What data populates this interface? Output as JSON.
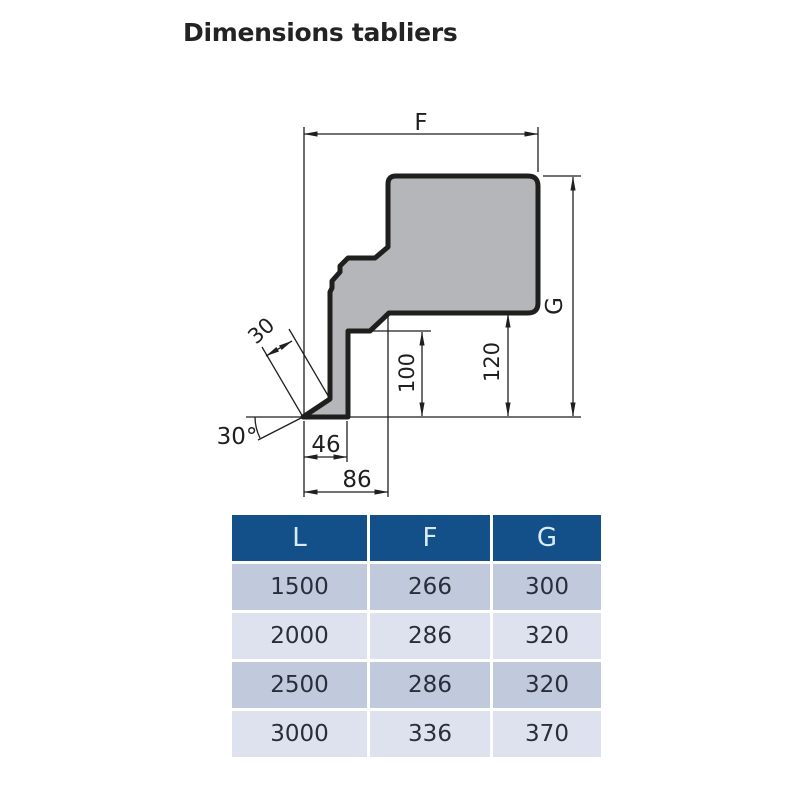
{
  "title": "Dimensions tabliers",
  "colors": {
    "bg": "#ffffff",
    "title_color": "#232323",
    "line_color": "#1f1f1d",
    "shape_fill": "#b5b6b9",
    "header_bg": "#134f88",
    "header_text": "#d9ebf8",
    "row_odd": "#c1c9dc",
    "row_even": "#dde2ee",
    "cell_text": "#2a2e3a"
  },
  "diagram": {
    "labels": {
      "f": "F",
      "g": "G",
      "width30": "30",
      "angle30": "30°",
      "d46": "46",
      "d86": "86",
      "d100": "100",
      "d120": "120"
    }
  },
  "table": {
    "headers": [
      "L",
      "F",
      "G"
    ],
    "rows": [
      [
        "1500",
        "266",
        "300"
      ],
      [
        "2000",
        "286",
        "320"
      ],
      [
        "2500",
        "286",
        "320"
      ],
      [
        "3000",
        "336",
        "370"
      ]
    ]
  }
}
